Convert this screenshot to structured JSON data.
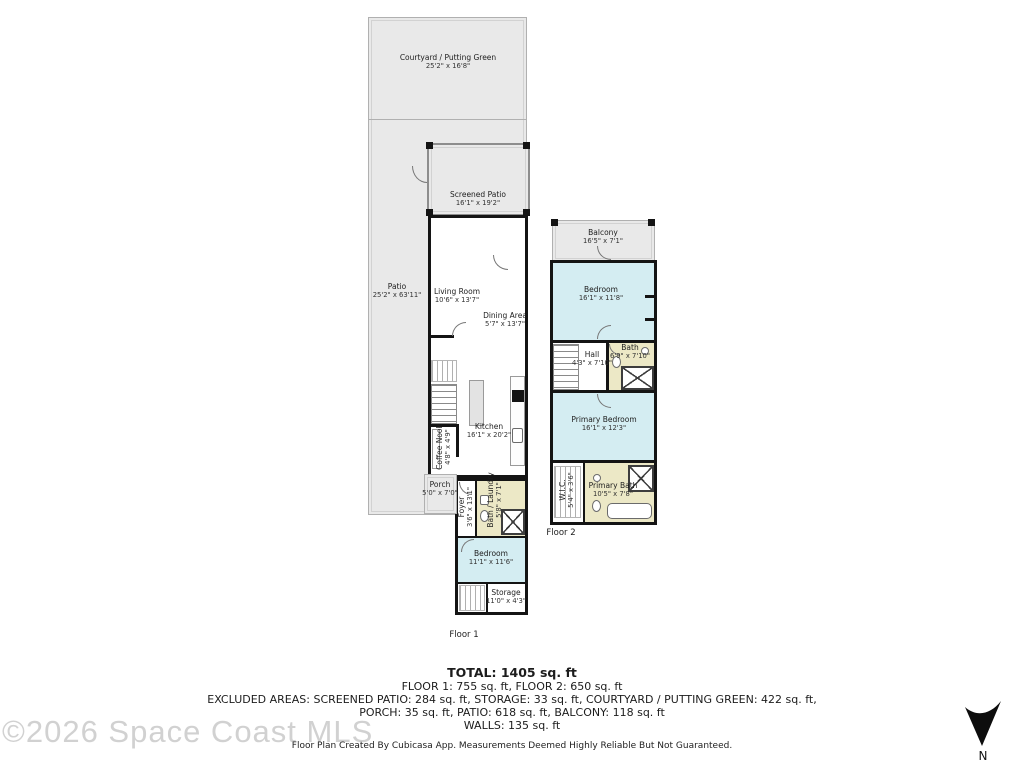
{
  "floor1": {
    "label": "Floor 1",
    "areas": {
      "courtyard": {
        "name": "Courtyard / Putting Green",
        "dims": "25'2\" x 16'8\""
      },
      "patio": {
        "name": "Patio",
        "dims": "25'2\" x 63'11\""
      },
      "screened_patio": {
        "name": "Screened Patio",
        "dims": "16'1\" x 19'2\""
      },
      "living_room": {
        "name": "Living Room",
        "dims": "10'6\" x 13'7\""
      },
      "dining_area": {
        "name": "Dining Area",
        "dims": "5'7\" x 13'7\""
      },
      "kitchen": {
        "name": "Kitchen",
        "dims": "16'1\" x 20'2\""
      },
      "coffee_nook": {
        "name": "Coffee Nook",
        "dims": "4'8\" x 4'9\""
      },
      "porch": {
        "name": "Porch",
        "dims": "5'0\" x 7'0\""
      },
      "foyer": {
        "name": "Foyer",
        "dims": "3'6\" x 13'1\""
      },
      "bath_laundry": {
        "name": "Bath / Laundry",
        "dims": "5'8\" x 7'1\""
      },
      "bedroom": {
        "name": "Bedroom",
        "dims": "11'1\" x 11'6\""
      },
      "storage": {
        "name": "Storage",
        "dims": "11'0\" x 4'3\""
      }
    }
  },
  "floor2": {
    "label": "Floor 2",
    "areas": {
      "balcony": {
        "name": "Balcony",
        "dims": "16'5\" x 7'1\""
      },
      "bedroom": {
        "name": "Bedroom",
        "dims": "16'1\" x 11'8\""
      },
      "hall": {
        "name": "Hall",
        "dims": "4'3\" x 7'10\""
      },
      "bath": {
        "name": "Bath",
        "dims": "6'9\" x 7'10\""
      },
      "primary_bedroom": {
        "name": "Primary Bedroom",
        "dims": "16'1\" x 12'3\""
      },
      "wic": {
        "name": "W.I.C.",
        "dims": "5'4\" x 3'6\""
      },
      "primary_bath": {
        "name": "Primary Bath",
        "dims": "10'5\" x 7'8\""
      }
    }
  },
  "summary": {
    "total": "TOTAL: 1405 sq. ft",
    "floors": "FLOOR 1: 755 sq. ft, FLOOR 2: 650 sq. ft",
    "excluded1": "EXCLUDED AREAS: SCREENED PATIO: 284 sq. ft, STORAGE: 33 sq. ft, COURTYARD / PUTTING GREEN: 422 sq. ft,",
    "excluded2": "PORCH: 35 sq. ft, PATIO: 618 sq. ft, BALCONY: 118 sq. ft",
    "walls": "WALLS: 135 sq. ft",
    "disclaimer": "Floor Plan Created By Cubicasa App. Measurements Deemed Highly Reliable But Not Guaranteed."
  },
  "watermark": "©2026 Space Coast MLS",
  "compass": {
    "label": "N"
  },
  "colors": {
    "room_blue": "#d4edf2",
    "bath_beige": "#ece8c6",
    "outdoor_gray": "#e9e9e9",
    "wall_black": "#141414"
  }
}
